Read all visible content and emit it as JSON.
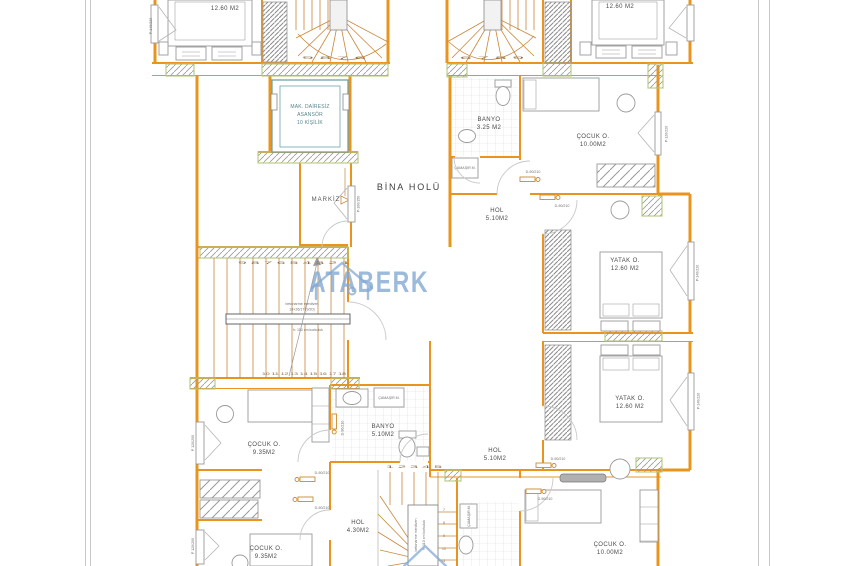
{
  "palette": {
    "wall": "#e8941f",
    "stair": "#c9873b",
    "hatch_edge": "#b3c87f",
    "furniture": "#9a9a9a",
    "elevator": "#6fa3a8",
    "watermark": "#84a9d3",
    "label": "#4a4a4a",
    "sheet_edge": "#c6c6c6"
  },
  "watermark": {
    "text": "ATABERK"
  },
  "labels": {
    "bina_holu": "BİNA HOLÜ",
    "markiz": "MARKİZ",
    "elevator": [
      "MAK. DAİRESİZ",
      "ASANSÖR",
      "10 KİŞİLİK"
    ],
    "camasir": "ÇAMAŞIR M.",
    "door": "D-90/210"
  },
  "windows": {
    "p140": "P-140/220",
    "p120_200": "P 120/200",
    "p120_220": "P-120/220",
    "p100": "P-100/150"
  },
  "stairs": {
    "main_note": [
      "betonarme merdiven",
      "18×26/17 (9/20)",
      "h: 110 cm korkuluk"
    ],
    "main_top_numbers": "9 8 7 6 5 4 3 2 1",
    "main_bottom_numbers": "10 11 12 13 14 15 16 17 18",
    "winder_left_numbers": "9 8 7 6",
    "winder_right_numbers": "6 7 8 9",
    "bottom_top_numbers": "1 2 3 4 5",
    "bottom_side_numbers": [
      "7",
      "8",
      "9",
      "10",
      "11"
    ],
    "bottom_note": [
      "betonarme merdiven",
      "h: 110 cm korkuluk"
    ]
  },
  "rooms": [
    {
      "id": "bed-top-left",
      "name": "",
      "area": "12.60 M2"
    },
    {
      "id": "bed-top-right",
      "name": "",
      "area": "12.60 M2"
    },
    {
      "id": "banyo-upper",
      "name": "BANYO",
      "area": "3.25 M2"
    },
    {
      "id": "cocuk-upper-right",
      "name": "ÇOCUK O.",
      "area": "10.00M2"
    },
    {
      "id": "hol-upper",
      "name": "HOL",
      "area": "5.10M2"
    },
    {
      "id": "yatak-upper",
      "name": "YATAK O.",
      "area": "12.60 M2"
    },
    {
      "id": "yatak-lower",
      "name": "YATAK O.",
      "area": "12.60 M2"
    },
    {
      "id": "cocuk-left-upper",
      "name": "ÇOCUK O.",
      "area": "9.35M2"
    },
    {
      "id": "banyo-lower",
      "name": "BANYO",
      "area": "5.10M2"
    },
    {
      "id": "hol-lower",
      "name": "HOL",
      "area": "5.10M2"
    },
    {
      "id": "hol-bottom",
      "name": "HOL",
      "area": "4.30M2"
    },
    {
      "id": "cocuk-left-lower",
      "name": "ÇOCUK O.",
      "area": "9.35M2"
    },
    {
      "id": "cocuk-bottom-right",
      "name": "ÇOCUK O.",
      "area": "10.00M2"
    }
  ]
}
